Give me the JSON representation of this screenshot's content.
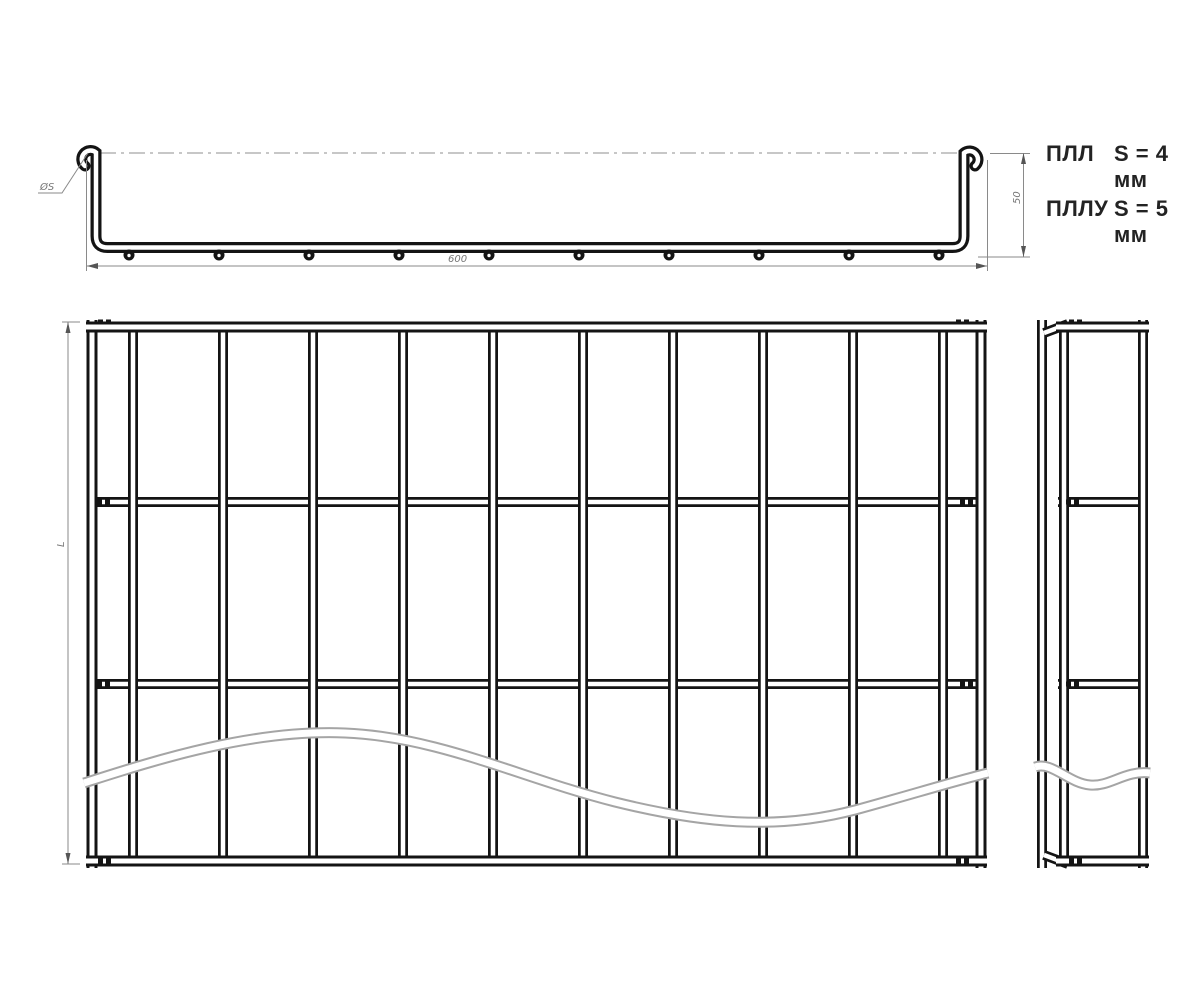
{
  "drawing": {
    "legend": [
      {
        "model": "ПЛЛ",
        "spec": "S = 4 мм"
      },
      {
        "model": "ПЛЛУ",
        "spec": "S = 5 мм"
      }
    ],
    "dims": {
      "width": "600",
      "height": "50",
      "length": "L",
      "diameter": "ØS"
    }
  }
}
